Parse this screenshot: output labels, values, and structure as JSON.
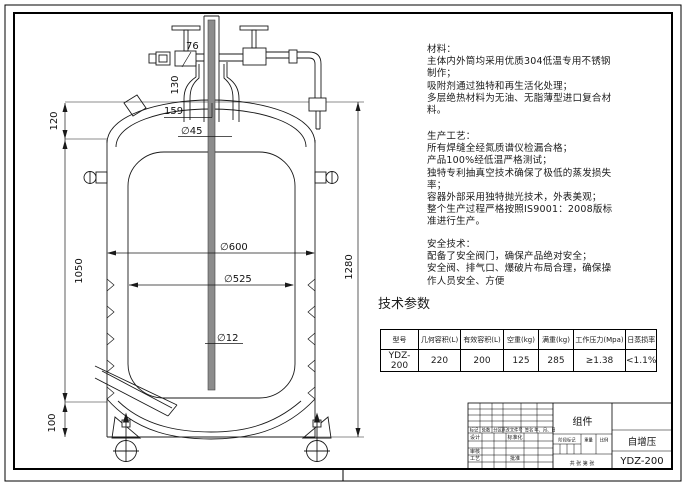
{
  "page": {
    "background": "#ffffff",
    "line_color": "#1a1a1a"
  },
  "notes": {
    "materials": {
      "title": "材料：",
      "body": "主体内外筒均采用优质304低温专用不锈钢\n制作；\n吸附剂通过独特和再生活化处理；\n多层绝热材料为无油、无脂薄型进口复合材\n料。"
    },
    "process": {
      "title": "生产工艺：",
      "body": "所有焊缝全经氮质谱仪检漏合格；\n产品100%经低温严格测试；\n独特专利抽真空技术确保了极低的蒸发损失\n率；\n容器外部采用独特抛光技术，外表美观；\n整个生产过程严格按照IS9001：2008版标\n准进行生产。"
    },
    "safety": {
      "title": "安全技术：",
      "body": "配备了安全阀门，确保产品绝对安全；\n安全阀、排气口、爆破片布局合理，确保操\n作人员安全、方便"
    }
  },
  "params": {
    "heading": "技术参数",
    "headers": [
      "型号",
      "几何容积(L)",
      "有效容积(L)",
      "空重(kg)",
      "满重(kg)",
      "工作压力(Mpa)",
      "日蒸损率"
    ],
    "row": [
      "YDZ-200",
      "220",
      "200",
      "125",
      "285",
      "≥1.38",
      "<1.1%"
    ]
  },
  "dims": {
    "neck_offset": "76",
    "neck_height": "130",
    "neck_plate": "159",
    "neck_dia": "∅45",
    "head_height": "120",
    "shell_height": "1050",
    "skirt_height": "100",
    "outer_dia": "∅600",
    "inner_dia": "∅525",
    "tube_dia": "∅12",
    "overall_height": "1280"
  },
  "title_block": {
    "part_name": "组件",
    "product_name": "自增压",
    "model": "YDZ-200",
    "rev_cols": [
      "标记",
      "处数",
      "分区",
      "更改文件号",
      "签名",
      "年、月、日"
    ],
    "roles": {
      "design": "设计",
      "standardize": "标准化",
      "review": "审核",
      "craft": "工艺",
      "approve": "批准"
    },
    "stage_cols": [
      "阶段标记",
      "重量",
      "比例"
    ],
    "sheet_note": "共 张 第 张"
  }
}
